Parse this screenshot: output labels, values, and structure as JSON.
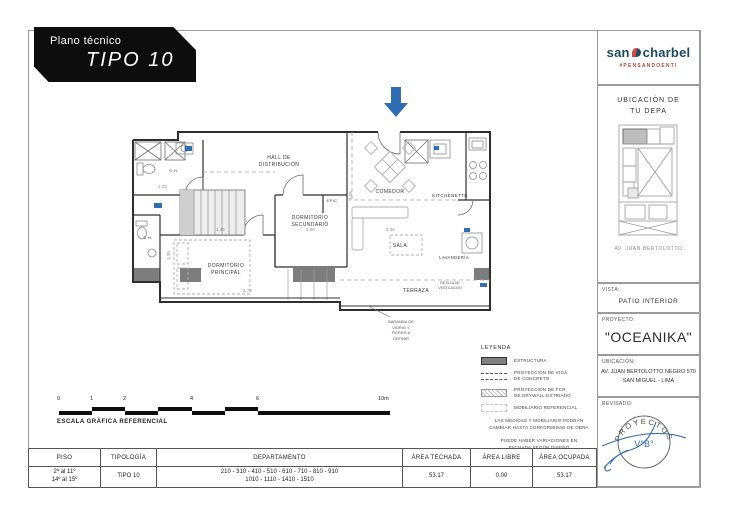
{
  "banner": {
    "subtitle": "Plano técnico",
    "title": "TIPO 10"
  },
  "logo": {
    "word1": "san",
    "word2": "charbel",
    "hashtag": "#PENSANDOENTI",
    "brand_navy": "#1c4a63",
    "brand_red": "#cf4b45"
  },
  "colors": {
    "accent_blue": "#2f6db5",
    "structure_gray": "#808080",
    "wall_black": "#2f2f2f"
  },
  "sidebar": {
    "ubicacion_depa": {
      "title": "UBICACIÓN DE\nTU DEPA",
      "caption": "AV. JUAN BERTOLOTTO"
    },
    "vista": {
      "label": "VISTA:",
      "value": "PATIO INTERIOR"
    },
    "proyecto": {
      "label": "PROYECTO:",
      "value": "\"OCEANIKA\""
    },
    "ubicacion": {
      "label": "UBICACIÓN:",
      "value": "AV. JUAN BERTOLOTTO NEGRO 570\nSAN MIGUEL - LIMA"
    },
    "revisado": {
      "label": "REVISADO:",
      "stamp_arc": "PROYECTOS",
      "stamp_center": "V°B°"
    }
  },
  "plan": {
    "rooms": {
      "hall": "HALL DE\nDISTRIBUCIÓN",
      "closet": "EPIC",
      "comedor": "COMEDOR",
      "kitchenette": "KITCHENETTE",
      "dormitorio_secundario": "DORMITORIO\nSECUNDARIO",
      "sala": "SALA",
      "lavanderia": "LAVANDERÍA",
      "dormitorio_principal": "DORMITORIO\nPRINCIPAL",
      "terraza": "TERRAZA",
      "bano_1": "S.H.",
      "bano_2": "S.H."
    },
    "notes": {
      "baranda": "BARANDA DE\nVIDRIO Y\nFIERRO A\nDEFINIR",
      "rejilla": "REJILLA DE\nVENTILACIÓN"
    },
    "dimensions": {
      "dorm_ppal_top": "3.45",
      "dorm_ppal_bottom": "3.79",
      "dorm_ppal_left": "1.30",
      "sala_top": "3.36",
      "terraza_top": "1.08",
      "bano_top": "1.25",
      "comedor_side": "3.05"
    }
  },
  "legend": {
    "title": "LEYENDA",
    "items": [
      {
        "swatch": "solid",
        "label": "ESTRUCTURA"
      },
      {
        "swatch": "dashed",
        "label": "PROYECCIÓN DE VIGA\nDE CONCRETO"
      },
      {
        "swatch": "hatch",
        "label": "PROYECCIÓN DE FCR\nDE DRYWALL ESTRIADO"
      },
      {
        "swatch": "dotted",
        "label": "MOBILIARIO REFERENCIAL"
      }
    ],
    "notes": [
      "LAS MEDIDAS Y MOBILIARIO PODRÁN\nCAMBIAR HASTA CONFORMIDAD DE OBRA",
      "PUEDE HABER VARIACIONES EN\nFACHADA SEGÚN DISEÑO"
    ]
  },
  "scalebar": {
    "ticks": [
      "0",
      "1",
      "2",
      "4",
      "6",
      "10m"
    ],
    "caption": "ESCALA GRÁFICA REFERENCIAL"
  },
  "table": {
    "headers": [
      "PISO",
      "TIPOLOGÍA",
      "DEPARTAMENTO",
      "ÁREA TECHADA",
      "ÁREA LIBRE",
      "ÁREA OCUPADA"
    ],
    "row": {
      "piso": "2º al 11º\n14º al 15º",
      "tipologia": "TIPO 10",
      "departamento": "210 - 310 - 410 - 510 - 610 - 710 - 810 - 910\n1010 - 1110 - 1410 - 1510",
      "area_techada": "53.17",
      "area_libre": "0.00",
      "area_ocupada": "53.17"
    }
  }
}
